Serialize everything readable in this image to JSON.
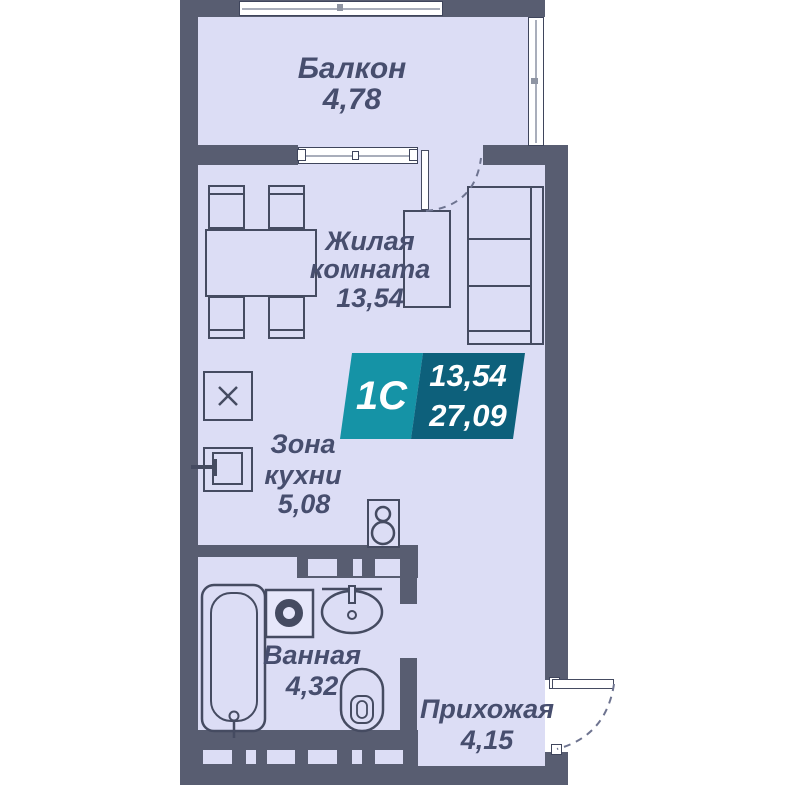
{
  "rooms": {
    "balcony": {
      "label": "Балкон",
      "area": "4,78"
    },
    "living_room": {
      "label_line1": "Жилая",
      "label_line2": "комната",
      "area": "13,54"
    },
    "kitchen": {
      "label_line1": "Зона",
      "label_line2": "кухни",
      "area": "5,08"
    },
    "bathroom": {
      "label": "Ванная",
      "area": "4,32"
    },
    "hallway": {
      "label": "Прихожая",
      "area": "4,15"
    }
  },
  "badge": {
    "unit_type": "1С",
    "living_area": "13,54",
    "total_area": "27,09",
    "color_left": "#1593a6",
    "color_right": "#0d607b"
  },
  "colors": {
    "wall": "#585d71",
    "floor": "#dcddf5",
    "furniture_line": "#454b61",
    "label_text": "#474e6e",
    "window_frame": "#3f455c",
    "window_glass": "#ffffff",
    "door_arc": "#6e7490",
    "background": "#ffffff"
  }
}
